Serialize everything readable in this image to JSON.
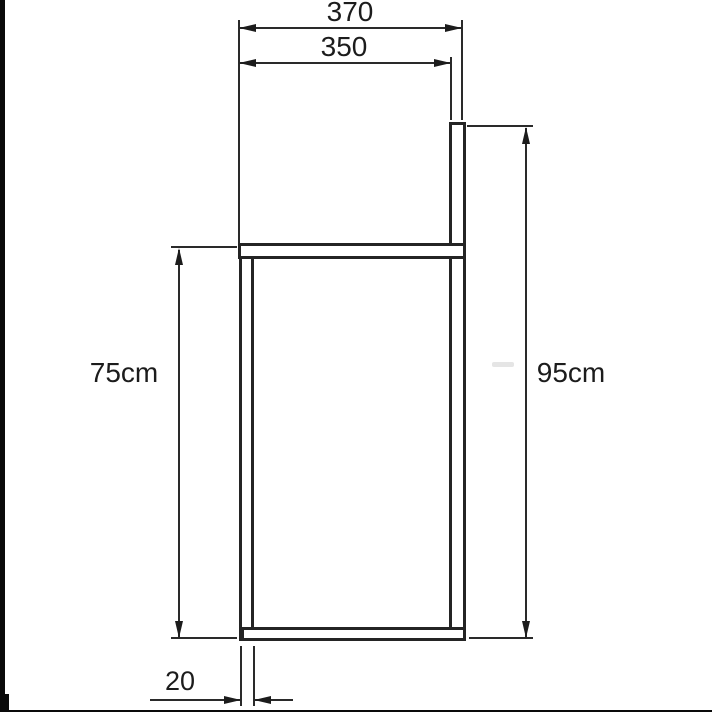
{
  "drawing": {
    "labels": {
      "overall_width": "370",
      "inner_width": "350",
      "left_height": "75cm",
      "right_height": "95cm",
      "profile_thickness": "20"
    },
    "colors": {
      "line": "#242424",
      "text": "#1c1c1c",
      "background": "#ffffff"
    }
  }
}
